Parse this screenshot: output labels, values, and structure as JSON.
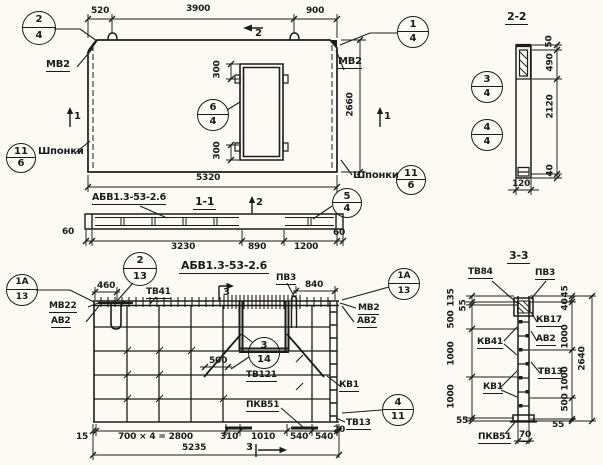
{
  "top": {
    "d520": "520",
    "d3900": "3900",
    "d900": "900",
    "d2660": "2660",
    "d5320": "5320",
    "d300t": "300",
    "d300b": "300",
    "mv2l": "МВ2",
    "mv2r": "МВ2",
    "shpl": "Шпонки",
    "shpr": "Шпонки",
    "m1l": "1",
    "m1r": "1",
    "m2": "2",
    "c24t": "2",
    "c24b": "4",
    "c14t": "1",
    "c14b": "4",
    "c64t": "6",
    "c64b": "4",
    "ckt": "11",
    "ckb": "6"
  },
  "s22": {
    "title": "2-2",
    "d50": "50",
    "d490": "490",
    "d2120": "2120",
    "d40": "40",
    "d120": "120",
    "c34t": "3",
    "c34b": "4",
    "c44t": "4",
    "c44b": "4"
  },
  "s11": {
    "mark": "АБВ1.3-53-2.6",
    "title": "1-1",
    "m2": "2",
    "d60l": "60",
    "d3230": "3230",
    "d890": "890",
    "d1200": "1200",
    "d60r": "60",
    "c54t": "5",
    "c54b": "4"
  },
  "plan": {
    "title": "АБВ1.3-53-2.6",
    "tv41": "ТВ41",
    "mv22": "МВ22",
    "av2l": "АВ2",
    "pv3": "ПВ3",
    "mv2": "МВ2",
    "av2r": "АВ2",
    "tv121": "ТВ121",
    "kv1": "КВ1",
    "pkv51": "ПКВ51",
    "tv13": "ТВ13",
    "d460": "460",
    "d840": "840",
    "d500": "500",
    "d15": "15",
    "d2800": "700 × 4 = 2800",
    "d310": "310",
    "d1010": "1010",
    "d540a": "540",
    "d540b": "540",
    "d20": "20",
    "d5235": "5235",
    "m3t": "3",
    "m3b": "3",
    "c1a13t": "1А",
    "c1a13b": "13",
    "c213t": "2",
    "c213b": "13",
    "c314t": "3",
    "c314b": "14",
    "c411t": "4",
    "c411b": "11"
  },
  "s33": {
    "title": "3-3",
    "tv84": "ТВ84",
    "pv3": "ПВ3",
    "kv17": "КВ17",
    "av2": "АВ2",
    "tv13": "ТВ13",
    "kv41": "КВ41",
    "kv1": "КВ1",
    "pkv51": "ПКВ51",
    "d135": "135",
    "d55t": "55",
    "d500l": "500",
    "d1000l1": "1000",
    "d1000l2": "1000",
    "d55bl": "55",
    "d70": "70",
    "d45": "45",
    "d40": "40",
    "d1000r1": "1000",
    "d1000r2": "1000",
    "d500r": "500",
    "d55br": "55",
    "d2640": "2640"
  }
}
